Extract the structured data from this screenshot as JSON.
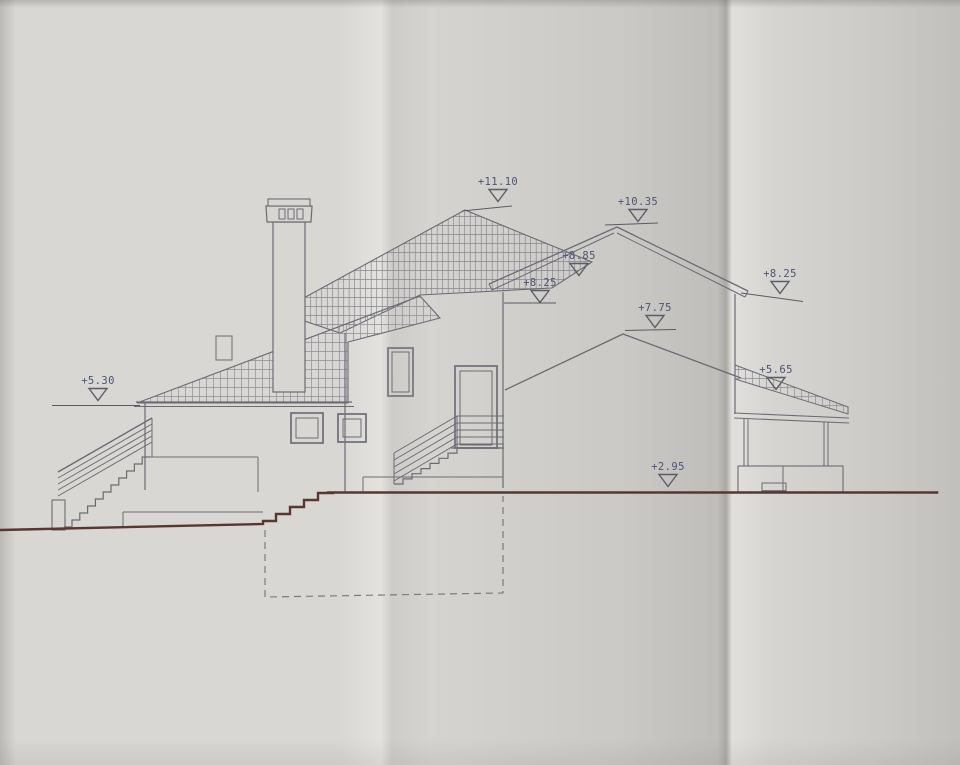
{
  "drawing": {
    "kind": "building side elevation",
    "elevation_markers": [
      {
        "id": "ridge-left",
        "label": "+11.10"
      },
      {
        "id": "ridge-right",
        "label": "+10.35"
      },
      {
        "id": "gable-slope",
        "label": "+8.85"
      },
      {
        "id": "eave-center",
        "label": "+8.25"
      },
      {
        "id": "middle-roof-ridge",
        "label": "+7.75"
      },
      {
        "id": "eave-right",
        "label": "+8.25"
      },
      {
        "id": "porch-roof",
        "label": "+5.65"
      },
      {
        "id": "left-roof-eave",
        "label": "+5.30"
      },
      {
        "id": "ground-level",
        "label": "+2.95"
      }
    ],
    "colors": {
      "paper": "#d8d7d3",
      "line": "#6c6b74",
      "tile_hatch": "#8f8e97",
      "ground_line": "#563830",
      "marker_text": "#4d5474"
    },
    "icons": {
      "datum_triangle": "open inverted triangle (survey datum symbol)"
    }
  }
}
